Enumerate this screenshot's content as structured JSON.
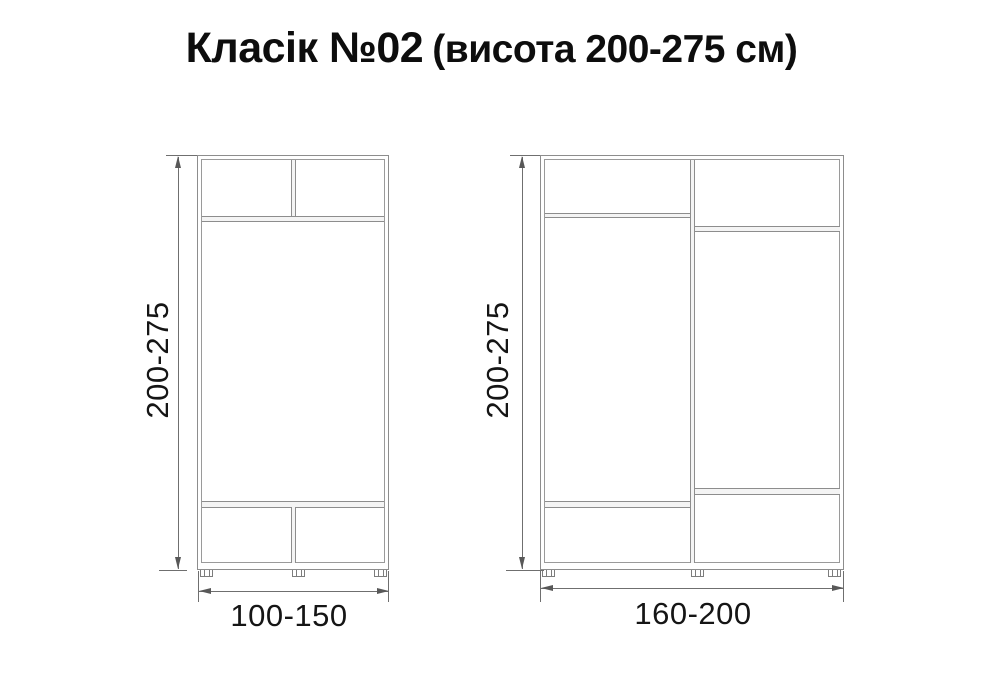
{
  "title": {
    "main": "Класік №02",
    "sub": "(висота 200-275 см)"
  },
  "colors": {
    "background": "#ffffff",
    "cabinet_line": "#8d8d8d",
    "dimension_line": "#6f6f6f",
    "arrow": "#585858",
    "text": "#111111"
  },
  "cabinets": [
    {
      "name": "small-wardrobe",
      "height_label": "200-275",
      "width_label": "100-150",
      "sections": "single body: two top cells over shelf, open middle, two bottom cells, three feet"
    },
    {
      "name": "large-wardrobe",
      "height_label": "200-275",
      "width_label": "160-200",
      "sections": "two vertical sections: each with top shelf and bottom shelf at offset heights, three feet"
    }
  ]
}
